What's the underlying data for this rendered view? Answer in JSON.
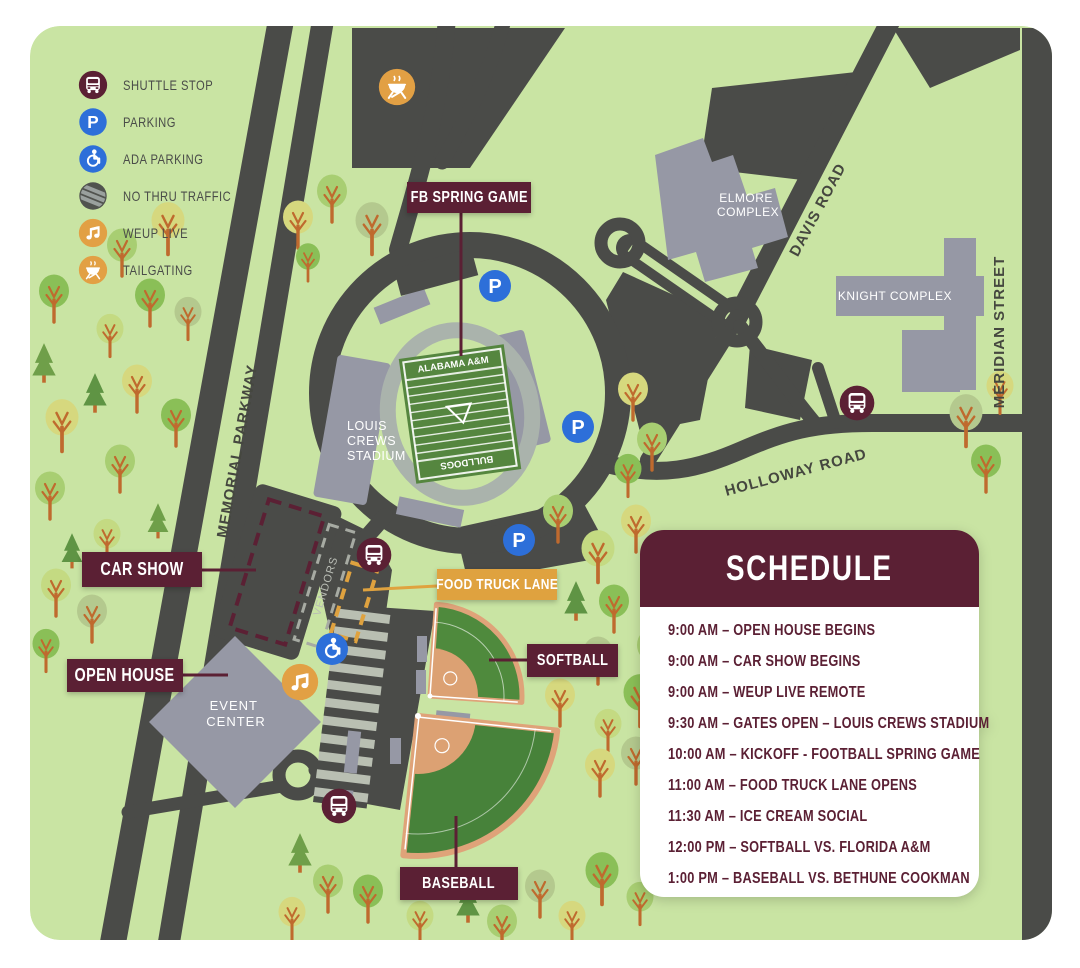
{
  "legend": {
    "items": [
      {
        "icon": "shuttle-stop-icon",
        "label": "SHUTTLE STOP"
      },
      {
        "icon": "parking-icon",
        "label": "PARKING"
      },
      {
        "icon": "ada-parking-icon",
        "label": "ADA PARKING"
      },
      {
        "icon": "no-thru-traffic-icon",
        "label": "NO THRU TRAFFIC"
      },
      {
        "icon": "weup-live-icon",
        "label": "WEUP LIVE"
      },
      {
        "icon": "tailgating-icon",
        "label": "TAILGATING"
      }
    ]
  },
  "roads": {
    "memorial_parkway": "MEMORIAL PARKWAY",
    "davis_road": "DAVIS ROAD",
    "meridian_street": "MERIDIAN STREET",
    "holloway_road": "HOLLOWAY ROAD"
  },
  "places": {
    "louis_crews_stadium": [
      "LOUIS",
      "CREWS",
      "STADIUM"
    ],
    "event_center": [
      "EVENT",
      "CENTER"
    ],
    "elmore_complex": [
      "ELMORE",
      "COMPLEX"
    ],
    "knight_complex": "KNIGHT COMPLEX",
    "vendors": "VENDORS",
    "field_end_home": "ALABAMA A&M",
    "field_end_away": "BULLDOGS",
    "parking_glyph": "P"
  },
  "callouts": {
    "fb_spring_game": "FB SPRING GAME",
    "car_show": "CAR SHOW",
    "open_house": "OPEN HOUSE",
    "food_truck_lane": "FOOD TRUCK LANE",
    "softball": "SOFTBALL",
    "baseball": "BASEBALL"
  },
  "schedule": {
    "title": "SCHEDULE",
    "items": [
      "9:00 AM – OPEN HOUSE BEGINS",
      "9:00 AM – CAR SHOW BEGINS",
      "9:00 AM – WEUP LIVE REMOTE",
      "9:30 AM – GATES OPEN – LOUIS CREWS STADIUM",
      "10:00 AM – KICKOFF - FOOTBALL SPRING GAME",
      "11:00 AM – FOOD TRUCK LANE OPENS",
      "11:30 AM – ICE CREAM SOCIAL",
      "12:00 PM – SOFTBALL VS. FLORIDA A&M",
      "1:00 PM – BASEBALL VS. BETHUNE COOKMAN"
    ]
  },
  "colors": {
    "maroon": "#5b2034",
    "orange": "#dfa23f",
    "parking_blue": "#2d6fd9",
    "map_green": "#c9e4a3",
    "road_gray": "#4a4b48",
    "building_gray": "#9698a5"
  }
}
